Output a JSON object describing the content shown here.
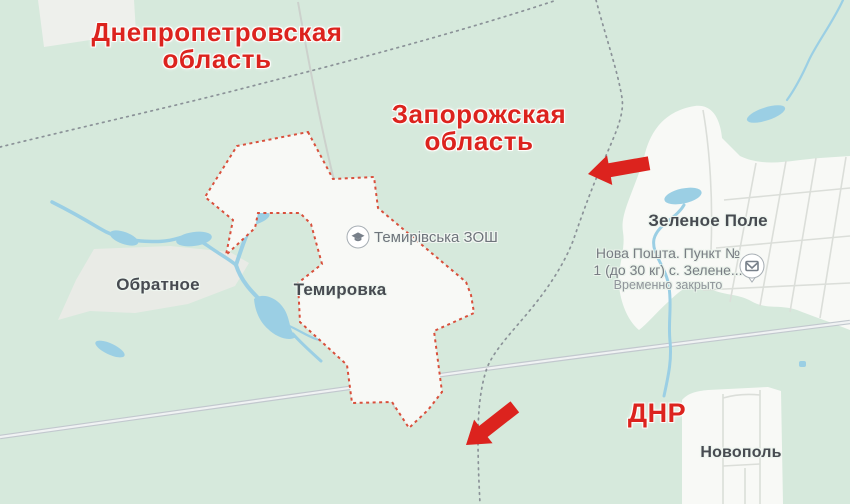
{
  "annotations": {
    "regions": [
      {
        "name": "dnipropetrovsk-oblast",
        "line1": "Днепропетровская",
        "line2": "область"
      },
      {
        "name": "zaporizhzhia-oblast",
        "line1": "Запорожская",
        "line2": "область"
      },
      {
        "name": "dnr",
        "line1": "ДНР",
        "line2": ""
      }
    ],
    "arrows": [
      {
        "name": "advance-arrow-west",
        "direction": "left"
      },
      {
        "name": "advance-arrow-southwest",
        "direction": "down-left"
      }
    ]
  },
  "places": [
    {
      "name": "obratnoe",
      "label": "Обратное"
    },
    {
      "name": "temirovka",
      "label": "Темировка"
    },
    {
      "name": "zelenoe-pole",
      "label": "Зеленое Поле"
    },
    {
      "name": "novopol",
      "label": "Новополь"
    }
  ],
  "pois": {
    "school": {
      "label": "Темирівська ЗОШ",
      "icon": "graduation-cap-icon"
    },
    "nova_poshta": {
      "line1": "Нова Пошта. Пункт №",
      "line2": "1 (до 30 кг) с. Зелене...",
      "status": "Временно закрыто",
      "icon": "envelope-icon"
    }
  },
  "map_colors": {
    "land": "#d6e9dc",
    "settlement": "#f8f9f6",
    "field": "#e9ebe6",
    "water": "#9bcfe4",
    "road": "#f0f2f3",
    "road_casing": "#c2c8ce",
    "admin_boundary": "#8b9298",
    "locality_boundary": "#d9503c",
    "place_label": "#474b51",
    "poi_label": "#6e747b",
    "annotation_red": "#dc231e"
  }
}
